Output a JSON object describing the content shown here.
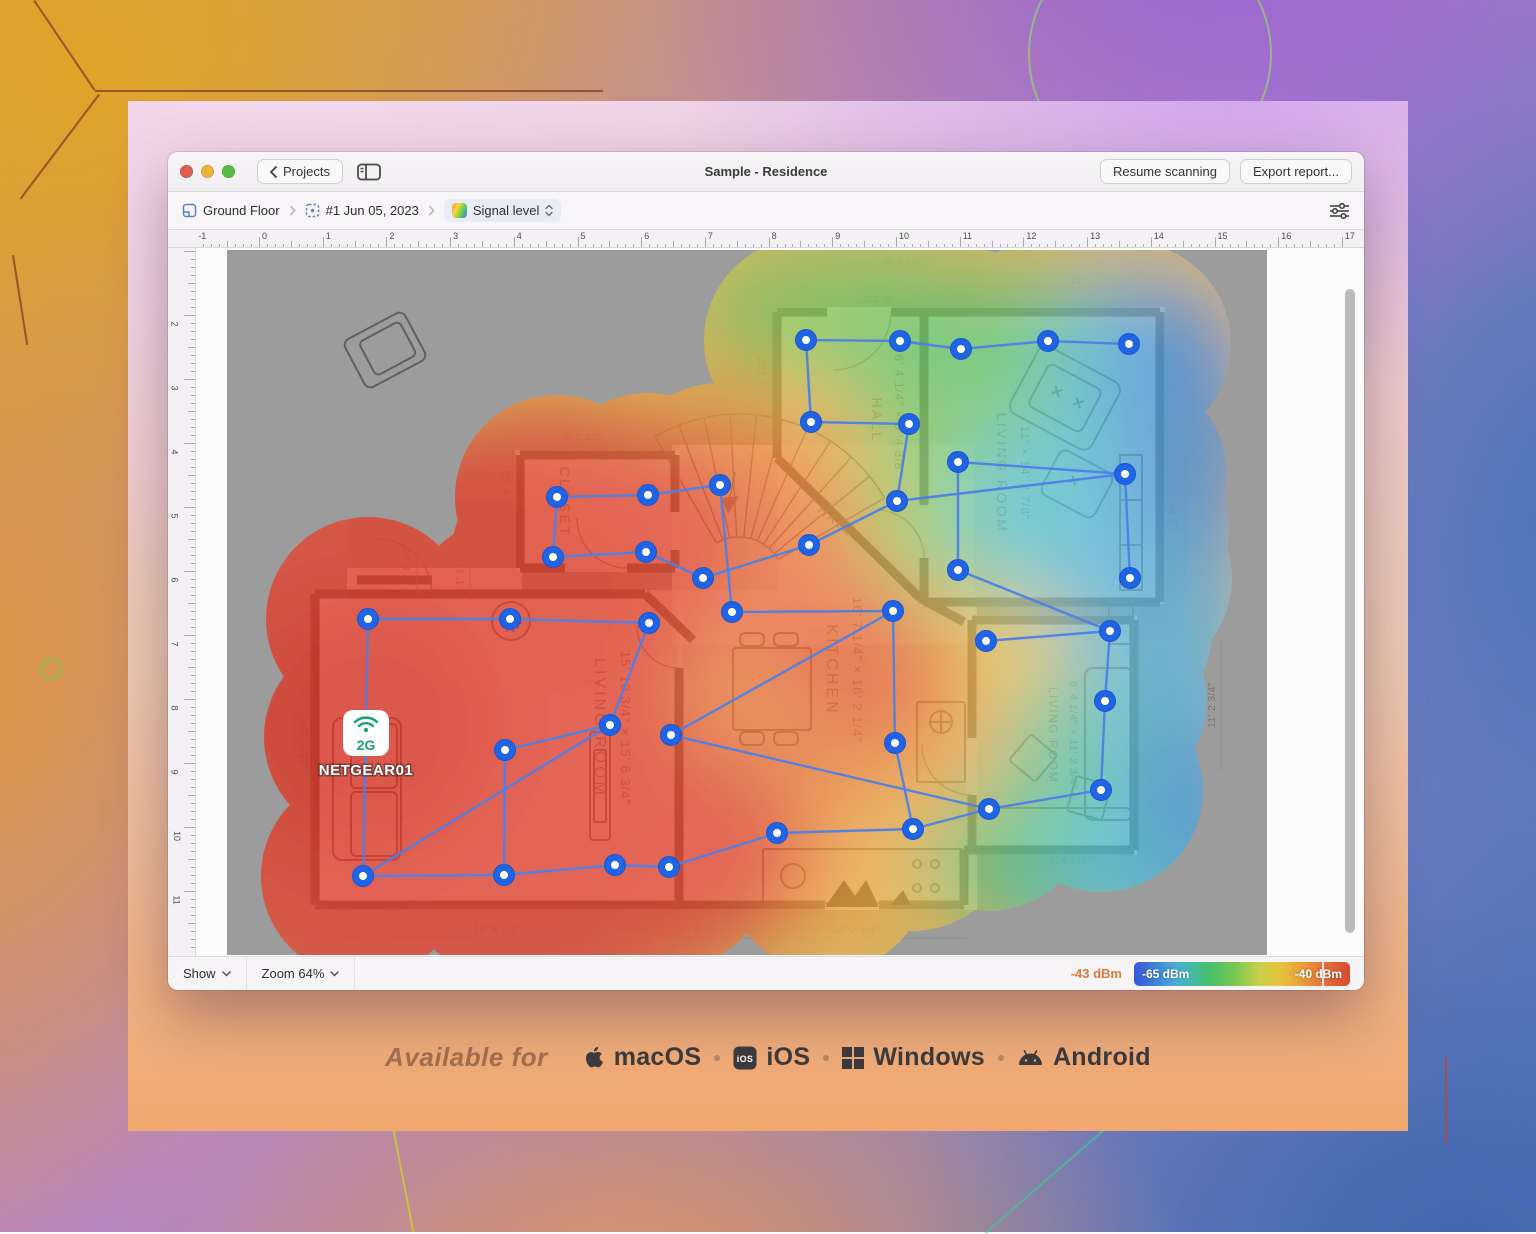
{
  "window": {
    "back_label": "Projects",
    "title": "Sample - Residence",
    "actions": [
      "Resume scanning",
      "Export report..."
    ]
  },
  "toolbar": {
    "breadcrumb": [
      {
        "label": "Ground Floor"
      },
      {
        "label": "#1 Jun 05, 2023"
      },
      {
        "label": "Signal level"
      }
    ]
  },
  "rulers": {
    "h_numbers": [
      -1,
      0,
      1,
      2,
      3,
      4,
      5,
      6,
      7,
      8,
      9,
      10,
      11,
      12,
      13,
      14,
      15,
      16,
      17
    ],
    "v_numbers": [
      2,
      3,
      4,
      5,
      6,
      7,
      8,
      9,
      10,
      11,
      12
    ]
  },
  "statusbar": {
    "show": "Show",
    "zoom": "Zoom 64%",
    "reading": "-43 dBm",
    "scale_min": "-65 dBm",
    "scale_max": "-40 dBm"
  },
  "access_point": {
    "band": "2G",
    "name": "NETGEAR01"
  },
  "heatmap": {
    "base_color": "#efbd4e",
    "line_color": "#4d7fe8",
    "point_color": "#1f63e6",
    "point_ring": "#1a56c9",
    "ap": [
      139,
      487
    ],
    "points": [
      [
        579,
        90
      ],
      [
        673,
        91
      ],
      [
        734,
        99
      ],
      [
        821,
        91
      ],
      [
        902,
        94
      ],
      [
        584,
        172
      ],
      [
        682,
        174
      ],
      [
        731,
        212
      ],
      [
        898,
        224
      ],
      [
        731,
        320
      ],
      [
        903,
        328
      ],
      [
        330,
        247
      ],
      [
        421,
        245
      ],
      [
        493,
        235
      ],
      [
        326,
        307
      ],
      [
        419,
        302
      ],
      [
        476,
        328
      ],
      [
        582,
        295
      ],
      [
        670,
        251
      ],
      [
        505,
        362
      ],
      [
        666,
        361
      ],
      [
        759,
        391
      ],
      [
        883,
        381
      ],
      [
        878,
        451
      ],
      [
        668,
        493
      ],
      [
        874,
        540
      ],
      [
        762,
        559
      ],
      [
        550,
        583
      ],
      [
        686,
        579
      ],
      [
        141,
        369
      ],
      [
        283,
        369
      ],
      [
        422,
        373
      ],
      [
        383,
        475
      ],
      [
        278,
        500
      ],
      [
        136,
        626
      ],
      [
        277,
        625
      ],
      [
        388,
        615
      ],
      [
        442,
        617
      ],
      [
        444,
        485
      ]
    ],
    "edges": [
      [
        0,
        1
      ],
      [
        1,
        2
      ],
      [
        2,
        3
      ],
      [
        3,
        4
      ],
      [
        0,
        5
      ],
      [
        5,
        6
      ],
      [
        6,
        18
      ],
      [
        7,
        8
      ],
      [
        7,
        9
      ],
      [
        8,
        10
      ],
      [
        18,
        8
      ],
      [
        17,
        18
      ],
      [
        16,
        17
      ],
      [
        15,
        16
      ],
      [
        14,
        15
      ],
      [
        11,
        14
      ],
      [
        11,
        12
      ],
      [
        12,
        13
      ],
      [
        13,
        19
      ],
      [
        19,
        20
      ],
      [
        20,
        24
      ],
      [
        21,
        22
      ],
      [
        22,
        23
      ],
      [
        23,
        25
      ],
      [
        25,
        26
      ],
      [
        26,
        28
      ],
      [
        9,
        22
      ],
      [
        24,
        28
      ],
      [
        27,
        28
      ],
      [
        37,
        27
      ],
      [
        36,
        37
      ],
      [
        35,
        36
      ],
      [
        34,
        35
      ],
      [
        29,
        34
      ],
      [
        29,
        30
      ],
      [
        30,
        31
      ],
      [
        31,
        32
      ],
      [
        32,
        33
      ],
      [
        33,
        35
      ],
      [
        34,
        32
      ],
      [
        38,
        26
      ],
      [
        38,
        20
      ]
    ],
    "mask_extra": [
      [
        250,
        430
      ],
      [
        380,
        420
      ],
      [
        450,
        560
      ],
      [
        560,
        300
      ],
      [
        620,
        470
      ],
      [
        700,
        100
      ],
      [
        760,
        300
      ],
      [
        820,
        450
      ],
      [
        600,
        620
      ],
      [
        860,
        160
      ],
      [
        900,
        280
      ],
      [
        139,
        487
      ]
    ],
    "spots": [
      [
        690,
        120,
        150,
        95,
        "#ecd24c",
        0.95
      ],
      [
        760,
        430,
        140,
        140,
        "#f0c447",
        0.9
      ],
      [
        600,
        180,
        170,
        110,
        "#f0a43f",
        0.85
      ],
      [
        640,
        570,
        230,
        120,
        "#f0a841",
        0.9
      ],
      [
        620,
        60,
        160,
        75,
        "#7cc85a",
        0.9
      ],
      [
        800,
        130,
        180,
        115,
        "#62c468",
        0.95
      ],
      [
        745,
        255,
        115,
        105,
        "#84ca5c",
        0.85
      ],
      [
        850,
        615,
        155,
        95,
        "#5cc272",
        0.95
      ],
      [
        880,
        500,
        105,
        95,
        "#55c49a",
        0.9
      ],
      [
        910,
        100,
        95,
        85,
        "#52bcd4",
        0.9
      ],
      [
        845,
        260,
        115,
        100,
        "#57c4dc",
        0.9
      ],
      [
        935,
        350,
        100,
        100,
        "#55b2e0",
        0.9
      ],
      [
        930,
        630,
        115,
        85,
        "#55c2d6",
        0.95
      ],
      [
        955,
        470,
        85,
        95,
        "#5cb8e0",
        0.9
      ],
      [
        965,
        200,
        85,
        105,
        "#4a90dc",
        0.85
      ],
      [
        945,
        88,
        75,
        65,
        "#4a8cdc",
        0.7
      ],
      [
        975,
        560,
        75,
        85,
        "#4a9adc",
        0.8
      ],
      [
        560,
        430,
        160,
        140,
        "#e87038",
        0.6
      ],
      [
        480,
        300,
        160,
        130,
        "#ea6a3a",
        0.7
      ],
      [
        640,
        420,
        100,
        80,
        "#e2402f",
        0.5
      ],
      [
        150,
        470,
        310,
        310,
        "#e24430",
        1
      ],
      [
        320,
        290,
        200,
        150,
        "#e24430",
        0.9
      ],
      [
        300,
        610,
        290,
        160,
        "#e24430",
        0.95
      ],
      [
        140,
        480,
        130,
        130,
        "#d93425",
        0.9
      ]
    ]
  },
  "floorplan": {
    "room_labels": [
      {
        "text": "LIVING ROOM",
        "x": 368,
        "y": 478,
        "rot": 90,
        "size": 16,
        "ls": 3
      },
      {
        "text": "15' 10 3/4\" × 15' 6 3/4\"",
        "x": 394,
        "y": 478,
        "rot": 90,
        "size": 13,
        "ls": 1
      },
      {
        "text": "KITCHEN",
        "x": 600,
        "y": 420,
        "rot": 90,
        "size": 16,
        "ls": 3
      },
      {
        "text": "16' 7 1/4\" × 16' 2 1/4\"",
        "x": 626,
        "y": 420,
        "rot": 90,
        "size": 13,
        "ls": 1
      },
      {
        "text": "LIVING ROOM",
        "x": 770,
        "y": 223,
        "rot": 90,
        "size": 14,
        "ls": 2.5
      },
      {
        "text": "11' × 14' 2 7/8\"",
        "x": 794,
        "y": 223,
        "rot": 90,
        "size": 12,
        "ls": 1
      },
      {
        "text": "LIVING ROOM",
        "x": 822,
        "y": 485,
        "rot": 90,
        "size": 12,
        "ls": 1.5
      },
      {
        "text": "8' 4 1/4\" × 11' 2 3/4\"",
        "x": 843,
        "y": 485,
        "rot": 90,
        "size": 11,
        "ls": 0.5
      },
      {
        "text": "HALL",
        "x": 645,
        "y": 170,
        "rot": 90,
        "size": 14,
        "ls": 2.5
      },
      {
        "text": "6' 4 1/4\" × 9' 4 3/8\"",
        "x": 668,
        "y": 165,
        "rot": 90,
        "size": 12,
        "ls": 1
      },
      {
        "text": "HALL",
        "x": 606,
        "y": 274,
        "rot": 38,
        "size": 13,
        "ls": 2
      },
      {
        "text": "CLOSET",
        "x": 333,
        "y": 252,
        "rot": 90,
        "size": 14,
        "ls": 2.5
      }
    ],
    "dim_labels": [
      {
        "text": "6' 4 1/4\"",
        "x": 678,
        "y": 16
      },
      {
        "text": "3' 1/2\"",
        "x": 648,
        "y": 46,
        "rot": 180
      },
      {
        "text": "11'",
        "x": 850,
        "y": 33
      },
      {
        "text": "5' 1/2\"",
        "x": 538,
        "y": 122,
        "rot": -90
      },
      {
        "text": "6' 2 1/2\"",
        "x": 357,
        "y": 190
      },
      {
        "text": "2' 8 5/8\"",
        "x": 283,
        "y": 236,
        "rot": -90
      },
      {
        "text": "1' 11\"",
        "x": 236,
        "y": 322,
        "rot": -90
      },
      {
        "text": "2' 8 3/4\"",
        "x": 183,
        "y": 312,
        "rot": -90
      },
      {
        "text": "15' 6 3/4\"",
        "x": 80,
        "y": 491,
        "rot": -90
      },
      {
        "text": "14' 8 1/2\"",
        "x": 270,
        "y": 683
      },
      {
        "text": "6'",
        "x": 471,
        "y": 683
      },
      {
        "text": "10' 2 1/8\"",
        "x": 629,
        "y": 683
      },
      {
        "text": "8' 4 1/4\"",
        "x": 843,
        "y": 613
      },
      {
        "text": "11' 2 3/4\"",
        "x": 988,
        "y": 455,
        "rot": -90
      },
      {
        "text": "13' 6\"",
        "x": 950,
        "y": 268,
        "rot": -90
      }
    ]
  },
  "footer": {
    "prefix": "Available for",
    "platforms": [
      "macOS",
      "iOS",
      "Windows",
      "Android"
    ]
  }
}
